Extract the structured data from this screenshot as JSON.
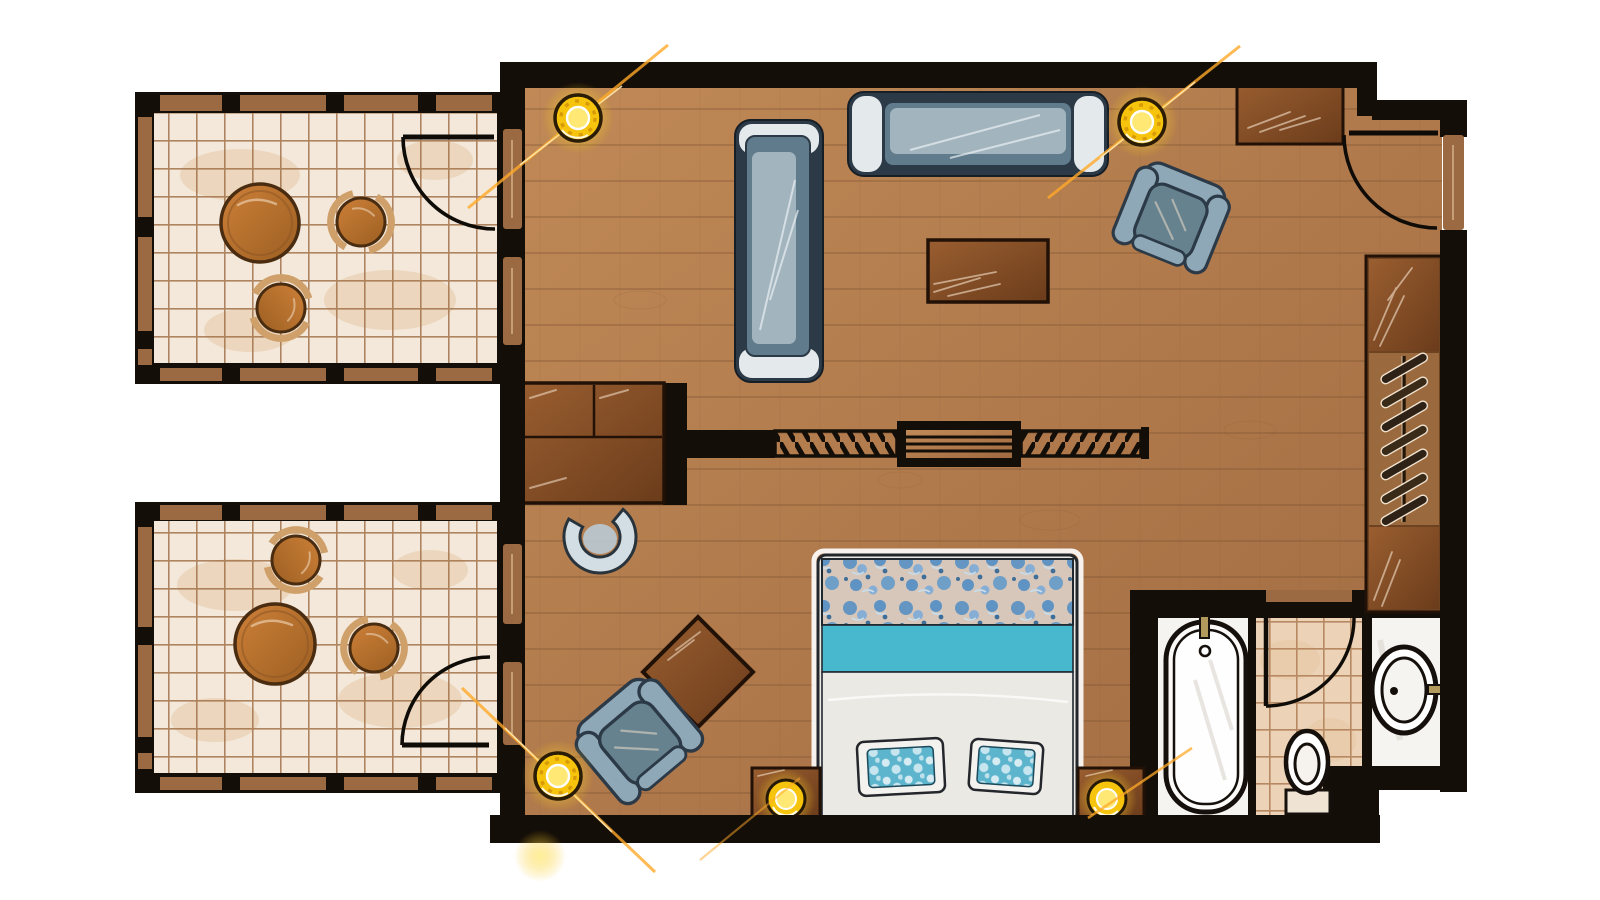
{
  "colors": {
    "white": "#ffffff",
    "wall": "#140e08",
    "woodA": "#c18a57",
    "woodB": "#a06a41",
    "woodLine": "#7c5230",
    "timber": "#9b6a43",
    "sketch": "#f5e3cd",
    "tile": "#f3e8da",
    "tileLine": "#9e6b42",
    "tileBlotch": "#e6c5a2",
    "furnA": "#9a5e30",
    "furnB": "#6b3c1b",
    "furnLine": "#221106",
    "tableA": "#cd8038",
    "tableB": "#9c5f22",
    "stoolBack": "#cfa06a",
    "sofaFrame": "#2c3a47",
    "sofaBody": "#5f7b8c",
    "sofaSeat": "#a2b5bf",
    "sofaHi": "#eef3f5",
    "chairBody": "#8fa8b8",
    "chairSeat": "#67828f",
    "teal": "#48b8cf",
    "duvet": "#ebe9e4",
    "floralBg": "#d6c7ba",
    "floralBlue": "#5f93c4",
    "floralDot": "#3f6f99",
    "pillowTeal": "#5cb4cd",
    "lamp": "#f6c30d",
    "lampCore": "#ffe874",
    "flare": "#ffa928",
    "bath": "#f6f4f1",
    "fixture": "#ffffff",
    "fixtureLine_note": "",
    "fixLine": "#15100b",
    "brass": "#b29a5c",
    "ttile": "#ecd2b6",
    "ttileLine": "#b2815a"
  },
  "rooms": {
    "terrace_top": "Upper terrace patio",
    "terrace_bottom": "Lower terrace patio",
    "living": "Living area",
    "bedroom": "Sleeping area",
    "entry": "Entry",
    "wardrobe": "Wardrobe closet",
    "bath_tub": "Bathroom - bathtub room",
    "bath_wc": "Bathroom - toilet room",
    "bath_sink": "Bathroom - washbasin room"
  },
  "furniture": {
    "sofa_side": "Chaise sofa",
    "sofa_long": "Three-seat sofa",
    "armchair_living": "Lounge armchair",
    "coffee_table": "Coffee table",
    "sideboard": "Sideboard cabinet",
    "desk": "Dresser desk",
    "desk_chair": "Curved desk chair",
    "sliding_partition": "Sliding partition divider",
    "bed": "Double bed with floral runner",
    "pillows": "Bed pillows",
    "nightstand_left": "Left nightstand with lamp",
    "nightstand_right": "Right nightstand with lamp",
    "side_table": "Diamond side table",
    "armchair_bedroom": "Bedroom armchair",
    "terrace_table": "Round patio table",
    "terrace_stools": "Patio stools",
    "hangers": "Clothes hangers",
    "bathtub": "Bathtub",
    "toilet": "Toilet",
    "washbasin": "Washbasin",
    "ceiling_lights": "Recessed spot lights",
    "entry_door": "Entry door",
    "terrace_doors": "Terrace doors",
    "wc_door": "Bathroom door"
  }
}
